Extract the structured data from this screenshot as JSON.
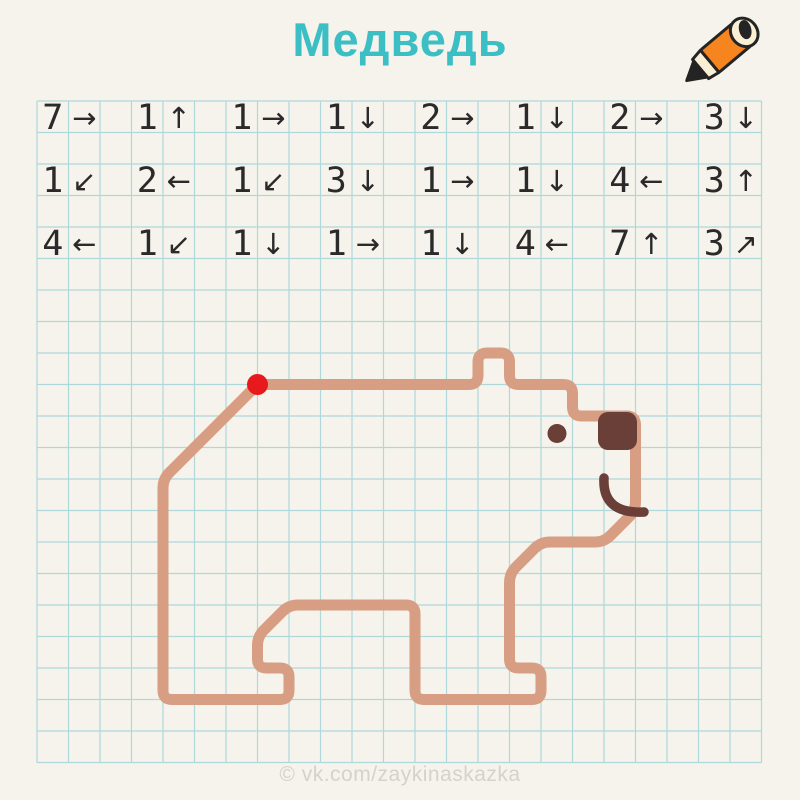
{
  "title": "Медведь",
  "watermark": "© vk.com/zaykinaskazka",
  "icons": {
    "pencil": "pencil-icon",
    "start_marker": "start-dot"
  },
  "colors": {
    "background": "#F5F3EB",
    "grid_line": "#AFD8DB",
    "title": "#3BBEC4",
    "instruction_text": "#2A2A2A",
    "bear_outline": "#D89E83",
    "bear_dark": "#693F37",
    "start_dot": "#E8191C",
    "pencil_orange": "#F6851F",
    "pencil_outline": "#242424",
    "pencil_wood": "#F8EFD4",
    "watermark_color": "#D5D2C8"
  },
  "puzzle": {
    "grid_cols": 23,
    "grid_rows": 21,
    "start_cell": {
      "col": 7,
      "row": 9
    }
  },
  "instructions": {
    "arrows": {
      "right": "→",
      "left": "←",
      "up": "↑",
      "down": "↓",
      "down_left": "↙",
      "up_right": "↗"
    },
    "rows": [
      [
        {
          "n": 7,
          "dir": "right"
        },
        {
          "n": 1,
          "dir": "up"
        },
        {
          "n": 1,
          "dir": "right"
        },
        {
          "n": 1,
          "dir": "down"
        },
        {
          "n": 2,
          "dir": "right"
        },
        {
          "n": 1,
          "dir": "down"
        },
        {
          "n": 2,
          "dir": "right"
        },
        {
          "n": 3,
          "dir": "down"
        }
      ],
      [
        {
          "n": 1,
          "dir": "down_left"
        },
        {
          "n": 2,
          "dir": "left"
        },
        {
          "n": 1,
          "dir": "down_left"
        },
        {
          "n": 3,
          "dir": "down"
        },
        {
          "n": 1,
          "dir": "right"
        },
        {
          "n": 1,
          "dir": "down"
        },
        {
          "n": 4,
          "dir": "left"
        },
        {
          "n": 3,
          "dir": "up"
        }
      ],
      [
        {
          "n": 4,
          "dir": "left"
        },
        {
          "n": 1,
          "dir": "down_left"
        },
        {
          "n": 1,
          "dir": "down"
        },
        {
          "n": 1,
          "dir": "right"
        },
        {
          "n": 1,
          "dir": "down"
        },
        {
          "n": 4,
          "dir": "left"
        },
        {
          "n": 7,
          "dir": "up"
        },
        {
          "n": 3,
          "dir": "up_right"
        }
      ]
    ]
  }
}
